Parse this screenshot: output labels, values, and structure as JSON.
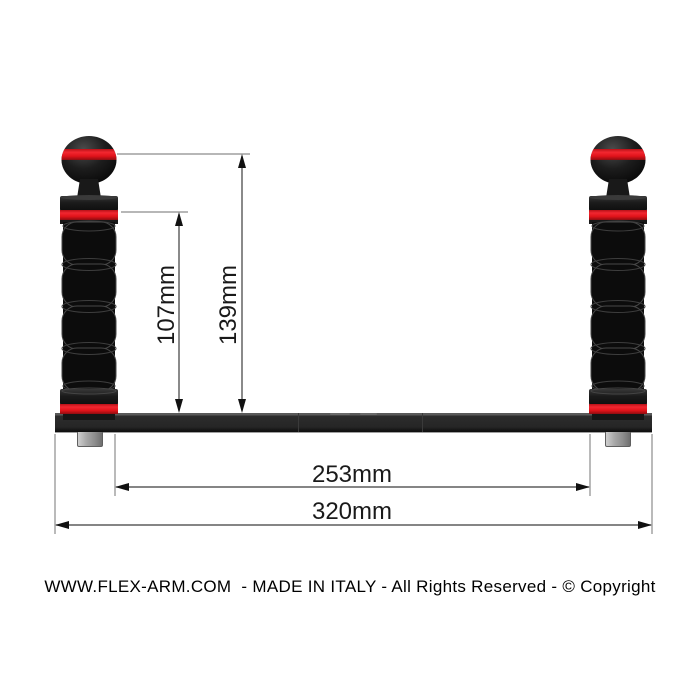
{
  "product": {
    "type": "underwater-flex-arm-tray-diagram"
  },
  "dimensions": {
    "d107": {
      "label": "107mm",
      "value_mm": 107
    },
    "d139": {
      "label": "139mm",
      "value_mm": 139
    },
    "d253": {
      "label": "253mm",
      "value_mm": 253
    },
    "d320": {
      "label": "320mm",
      "value_mm": 320
    }
  },
  "footer": {
    "text": "WWW.FLEX-ARM.COM  - MADE IN ITALY - All Rights Reserved - © Copyright"
  },
  "colors": {
    "accent_red": "#e8151b",
    "body_black": "#0d0d0d",
    "bar_gray": "#282828",
    "screw_silver": "#a8a8a8",
    "extension_line": "#8c8c8c",
    "dimension_line": "#3c3c3c",
    "arrow_black": "#111111"
  }
}
